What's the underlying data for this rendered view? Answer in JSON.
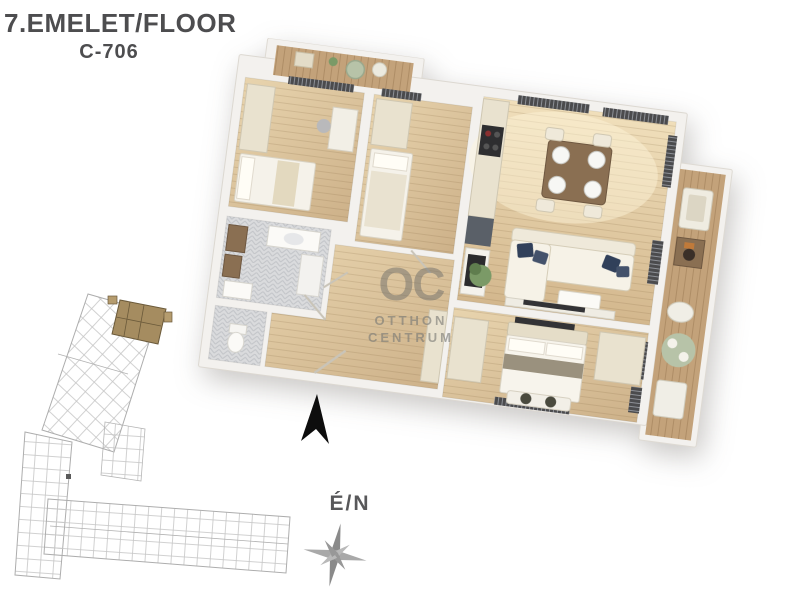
{
  "header": {
    "title": "7.EMELET/FLOOR",
    "unit": "C-706"
  },
  "watermark": {
    "monogram": "OC",
    "line1": "OTTHON",
    "line2": "CENTRUM"
  },
  "compass": {
    "label": "É/N"
  },
  "colors": {
    "title_text": "#4d4d4f",
    "wall": "#f3f1ee",
    "wood_floor": "#dcc49d",
    "deck_wood": "#c3a27a",
    "tile": "#d9dadc",
    "furniture_cream": "#e9e2cf",
    "pillow_navy": "#31405a",
    "plant_green": "#7b9a67",
    "sage": "#b7c3a8",
    "site_lines": "#c6c6c6",
    "site_highlight": "#a58c60",
    "north_arrow": "#0d0d0d",
    "compass_gray": "#8f8f8f",
    "watermark_gray": "#8b8b87"
  }
}
